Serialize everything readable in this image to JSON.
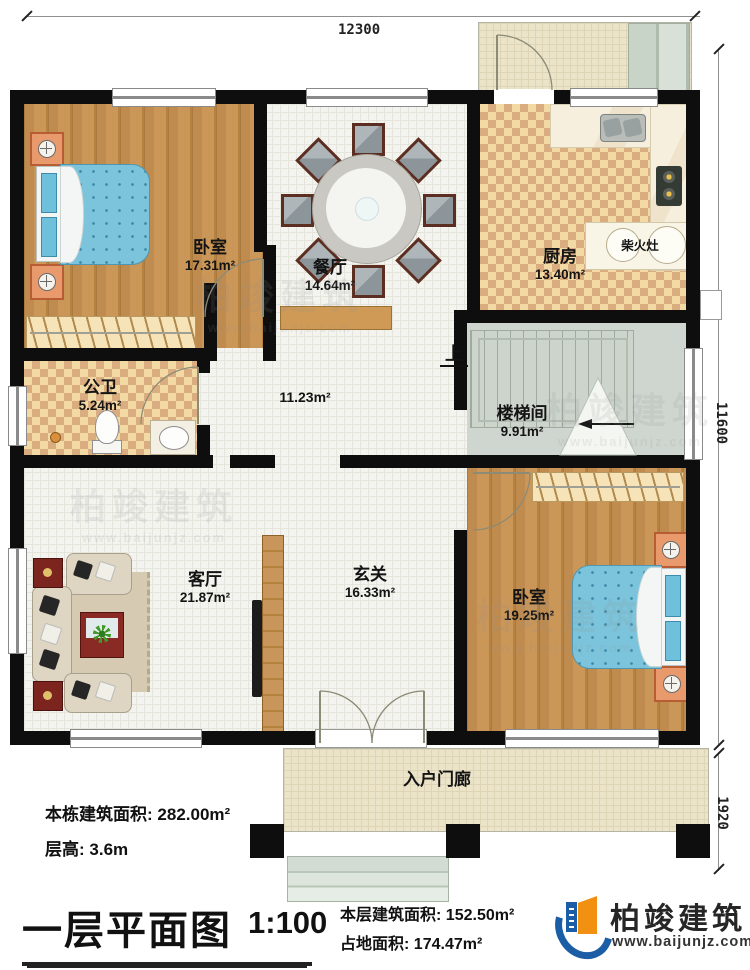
{
  "dims": {
    "top": "12300",
    "right_upper": "11600",
    "right_lower": "1920"
  },
  "rooms": [
    {
      "id": "bedroom1",
      "name": "卧室",
      "area": "17.31m²"
    },
    {
      "id": "dining",
      "name": "餐厅",
      "area": "14.64m²"
    },
    {
      "id": "kitchen",
      "name": "厨房",
      "area": "13.40m²"
    },
    {
      "id": "bath",
      "name": "公卫",
      "area": "5.24m²"
    },
    {
      "id": "hall",
      "name": "",
      "area": "11.23m²"
    },
    {
      "id": "stair",
      "name": "楼梯间",
      "area": "9.91m²"
    },
    {
      "id": "living",
      "name": "客厅",
      "area": "21.87m²"
    },
    {
      "id": "foyer",
      "name": "玄关",
      "area": "16.33m²"
    },
    {
      "id": "bedroom2",
      "name": "卧室",
      "area": "19.25m²"
    },
    {
      "id": "porch",
      "name": "入户门廊",
      "area": ""
    }
  ],
  "labels": {
    "stove": "柴火灶",
    "stairs_up": "上"
  },
  "footer": {
    "building_total_area_label": "本栋建筑面积:",
    "building_total_area": "282.00m²",
    "floor_height_label": "层高:",
    "floor_height": "3.6m",
    "plan_title": "一层平面图",
    "scale": "1:100",
    "floor_area_label": "本层建筑面积:",
    "floor_area": "152.50m²",
    "land_area_label": "占地面积:",
    "land_area": "174.47m²"
  },
  "brand": {
    "name": "柏竣建筑",
    "url": "www.baijunjz.com"
  },
  "colors": {
    "wood": "#c08b4e",
    "tile_light": "#f3d9a4",
    "tile_dark": "#d9ad80",
    "bed_blue": "#7cc4dc",
    "logo_blue": "#1b5ea6",
    "logo_orange": "#f29111",
    "wall": "#0e0e0e"
  }
}
